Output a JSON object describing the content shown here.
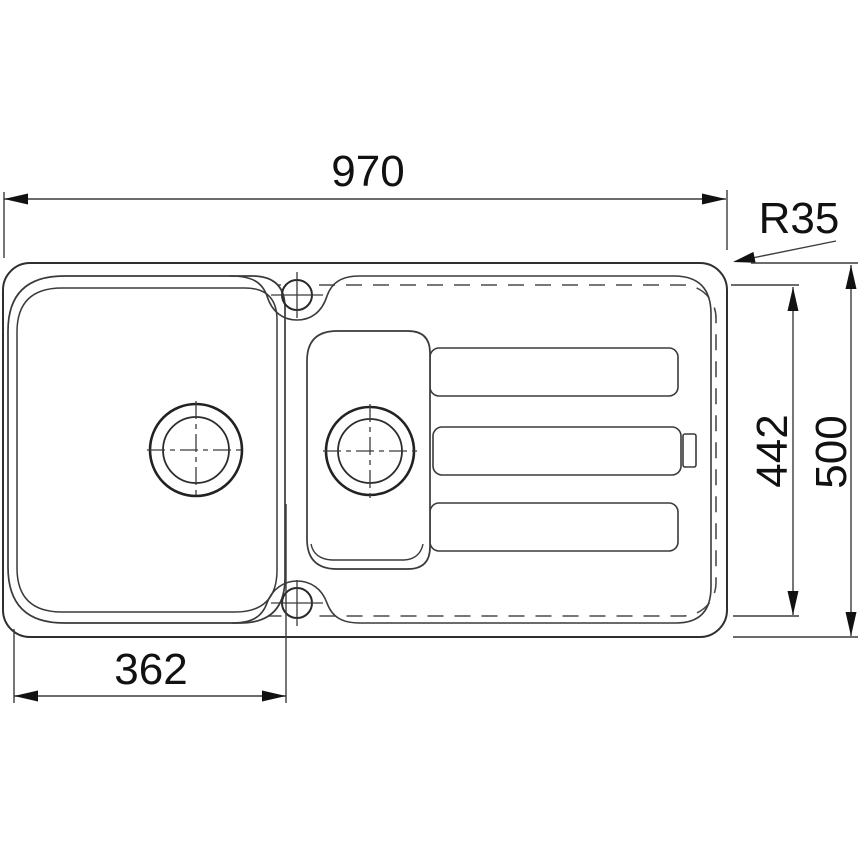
{
  "colors": {
    "background": "#ffffff",
    "line": "#3a3a3a",
    "dashed_line": "#4a4a4a",
    "dimension_line": "#3c3c3c",
    "arrow_fill": "#111111",
    "text": "#111111"
  },
  "diagram": {
    "labels": {
      "overall_width": "970",
      "corner_radius": "R35",
      "inner_depth": "442",
      "overall_depth": "500",
      "bowl_width": "362"
    }
  }
}
